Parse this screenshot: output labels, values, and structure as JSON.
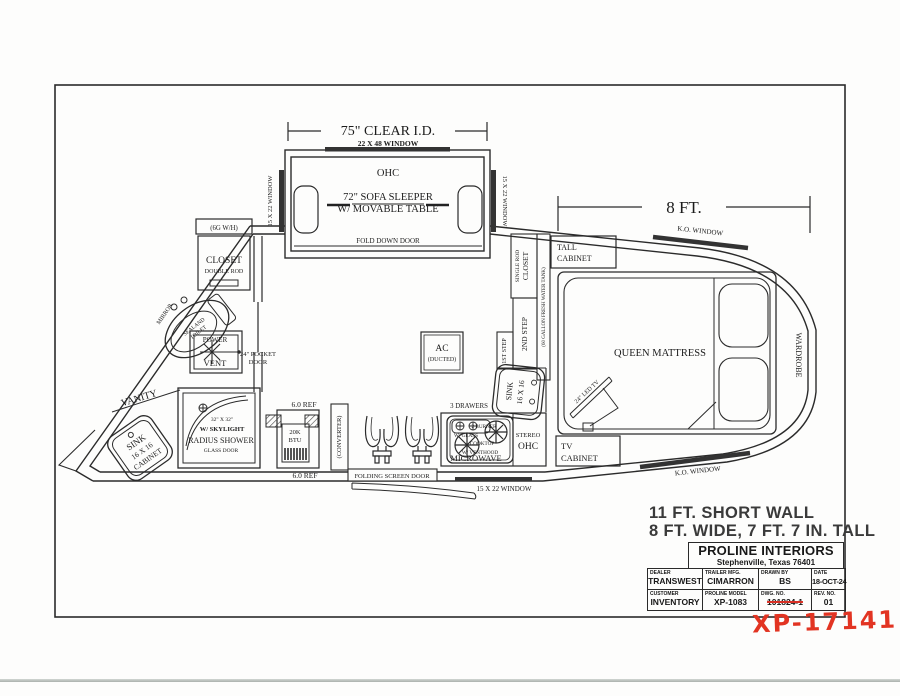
{
  "plan": {
    "sofa": {
      "dim75": "75\" CLEAR I.D.",
      "win_top": "22 X 48 WINDOW",
      "win_left": "15 X 22 WINDOW",
      "win_right": "15 X 22 WINDOW",
      "ohc": "OHC",
      "line1": "72\" SOFA SLEEPER",
      "line2": "W/  MOVABLE TABLE",
      "fold": "FOLD DOWN DOOR"
    },
    "bath": {
      "wh": "(6G W/H)",
      "closet1": "CLOSET",
      "closet2": "DOUBLE ROD",
      "mirror": "MIRROR",
      "toilet1": "SEALAND",
      "toilet2": "TOILET",
      "power": "POWER",
      "vent": "VENT",
      "pocket1": "24\" POCKET",
      "pocket2": "DOOR",
      "vanity": "VANITY",
      "sink1": "SINK",
      "sink2": "16 X 16",
      "sink3": "CABINET",
      "shower1": "32\" X 32\"",
      "shower2": "W/ SKYLIGHT",
      "shower3": "RADIUS SHOWER",
      "shower4": "GLASS DOOR"
    },
    "mid": {
      "ref_top": "6.0 REF",
      "furn1": "20K",
      "furn2": "BTU",
      "conv": "(CONVERTER)",
      "ref_bot": "6.0 REF",
      "door": "FOLDING SCREEN DOOR",
      "ac1": "AC",
      "ac2": "(DUCTED)",
      "win_bot": "15 X 22 WINDOW"
    },
    "kitchen": {
      "drawers": "3 DRAWERS",
      "sink1": "SINK",
      "sink2": "16 X 16",
      "ck1": "2 BURNER",
      "ck2": "W/ GLASS",
      "ck3": "COOKTOP",
      "ck4": "W/ VENTHOOD",
      "micro": "MICROWAVE",
      "stereo": "STEREO",
      "ohc": "OHC"
    },
    "steps": {
      "s1": "1ST STEP",
      "s2": "2ND STEP",
      "closet1": "CLOSET",
      "closet2": "SINGLE ROD",
      "tank": "(60 GALLON FRESH WATER TANK)",
      "tall1": "TALL",
      "tall2": "CABINET"
    },
    "bed": {
      "dim8": "8 FT.",
      "ko_top": "K.O. WINDOW",
      "ko_bot": "K.O. WINDOW",
      "queen": "QUEEN MATTRESS",
      "wardrobe": "WARDROBE",
      "tv": "24\" LED TV",
      "tvcab1": "TV",
      "tvcab2": "CABINET"
    }
  },
  "caption": {
    "line1": "11 FT. SHORT WALL",
    "line2": "8 FT. WIDE, 7 FT. 7 IN. TALL"
  },
  "title_block": {
    "company": "PROLINE INTERIORS",
    "address": "Stephenville, Texas  76401",
    "fields": [
      {
        "label": "DEALER",
        "value": "TRANSWEST"
      },
      {
        "label": "TRAILER MFG.",
        "value": "CIMARRON"
      },
      {
        "label": "DRAWN BY",
        "value": "BS"
      },
      {
        "label": "DATE",
        "value": "18-OCT-24"
      },
      {
        "label": "CUSTOMER",
        "value": "INVENTORY"
      },
      {
        "label": "PROLINE MODEL",
        "value": "XP-1083"
      },
      {
        "label": "DWG. NO.",
        "value": "101824-1"
      },
      {
        "label": "REV. NO.",
        "value": "01"
      }
    ],
    "handwritten": "XP-17141"
  },
  "colors": {
    "ink": "#1c1c1c",
    "red": "#d93025"
  }
}
